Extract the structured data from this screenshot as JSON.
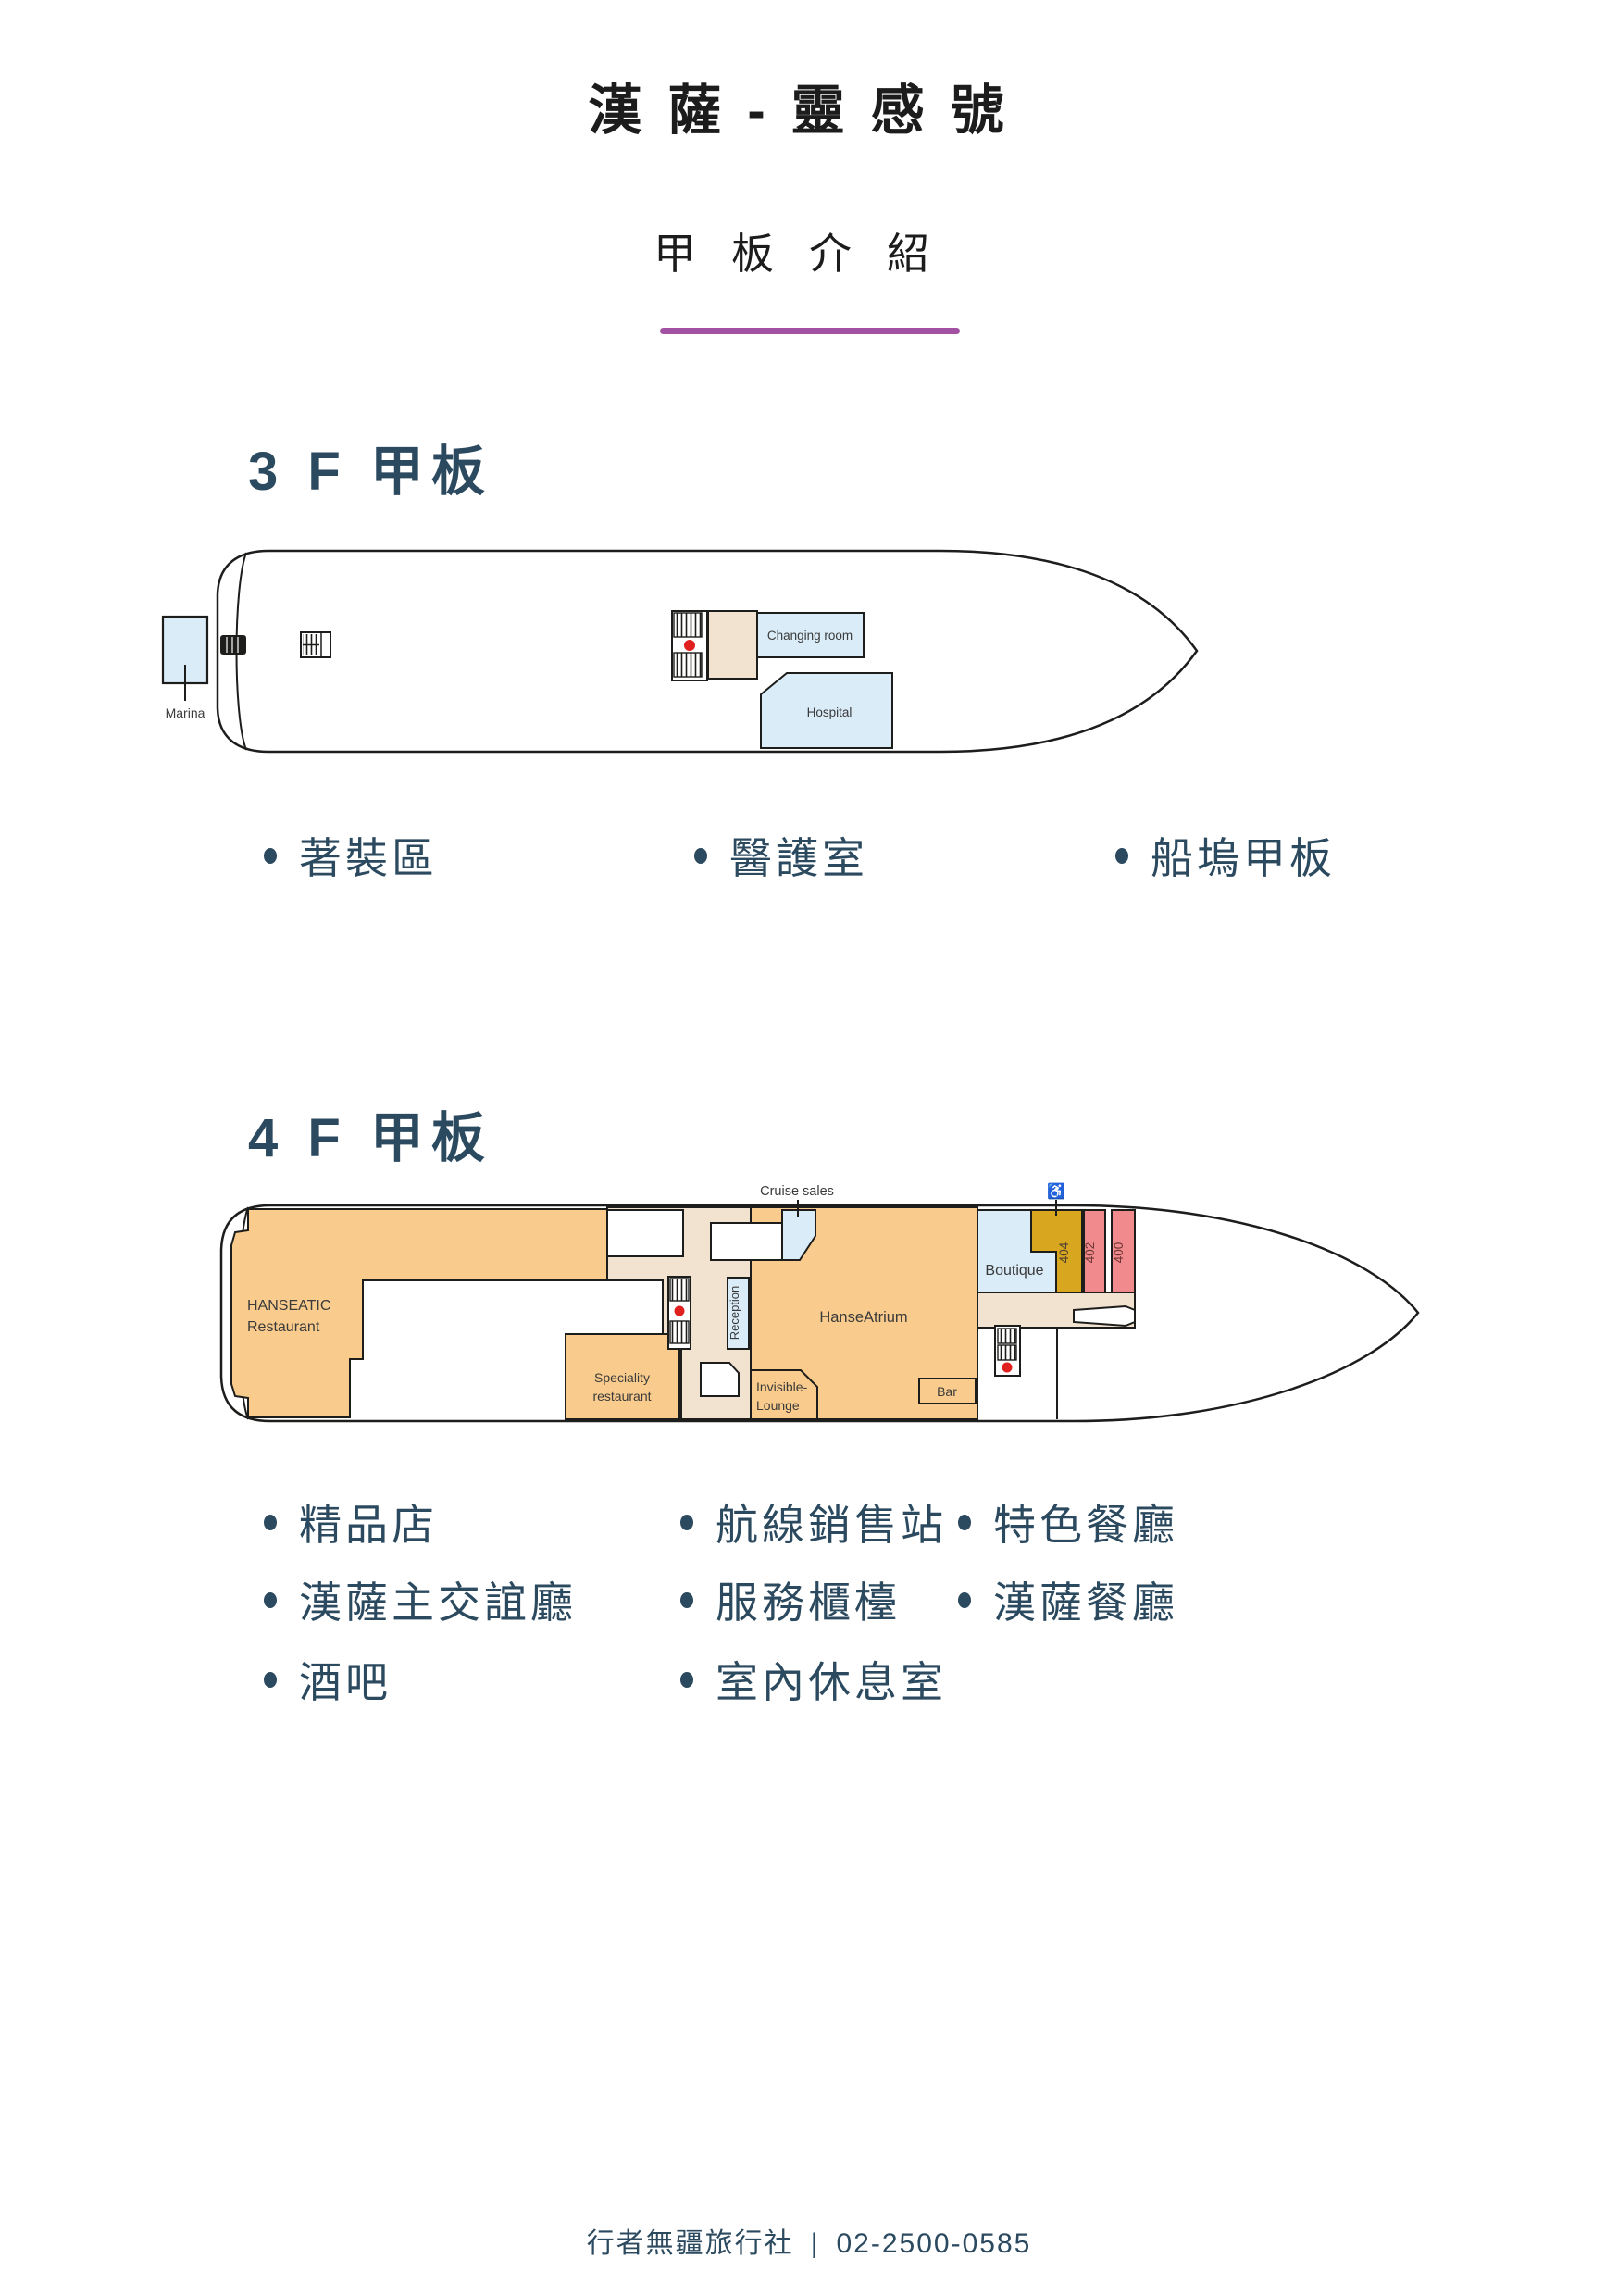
{
  "palette": {
    "accent_purple": "#a352a3",
    "heading_blue": "#2c4a5f",
    "outline_black": "#1d1d1b",
    "room_blue": "#daecf8",
    "deck_orange": "#f9cc8d",
    "corridor_beige": "#f2e3d1",
    "cabin_gold": "#d9a620",
    "cabin_pink": "#f18a8c",
    "elevator_red": "#e01f1f"
  },
  "header": {
    "title": "漢薩-靈感號",
    "subtitle": "甲板介紹"
  },
  "deck3": {
    "heading": "3 F 甲板",
    "map": {
      "marina": "Marina",
      "changing_room": "Changing room",
      "hospital": "Hospital"
    },
    "features": [
      "著裝區",
      "醫護室",
      "船塢甲板"
    ]
  },
  "deck4": {
    "heading": "4 F 甲板",
    "map": {
      "hanseatic_1": "HANSEATIC",
      "hanseatic_2": "Restaurant",
      "speciality_1": "Speciality",
      "speciality_2": "restaurant",
      "cruise_sales": "Cruise sales",
      "reception": "Reception",
      "hanse_atrium": "HanseAtrium",
      "invisible_1": "Invisible-",
      "invisible_2": "Lounge",
      "bar": "Bar",
      "boutique": "Boutique",
      "cabin_404": "404",
      "cabin_402": "402",
      "cabin_400": "400",
      "wheelchair_icon": "♿"
    },
    "features_col1": [
      "精品店",
      "漢薩主交誼廳",
      "酒吧"
    ],
    "features_col2": [
      "航線銷售站",
      "服務櫃檯",
      "室內休息室"
    ],
    "features_col3": [
      "特色餐廳",
      "漢薩餐廳"
    ]
  },
  "footer": {
    "agency": "行者無疆旅行社",
    "separator": "|",
    "phone": "02-2500-0585"
  }
}
